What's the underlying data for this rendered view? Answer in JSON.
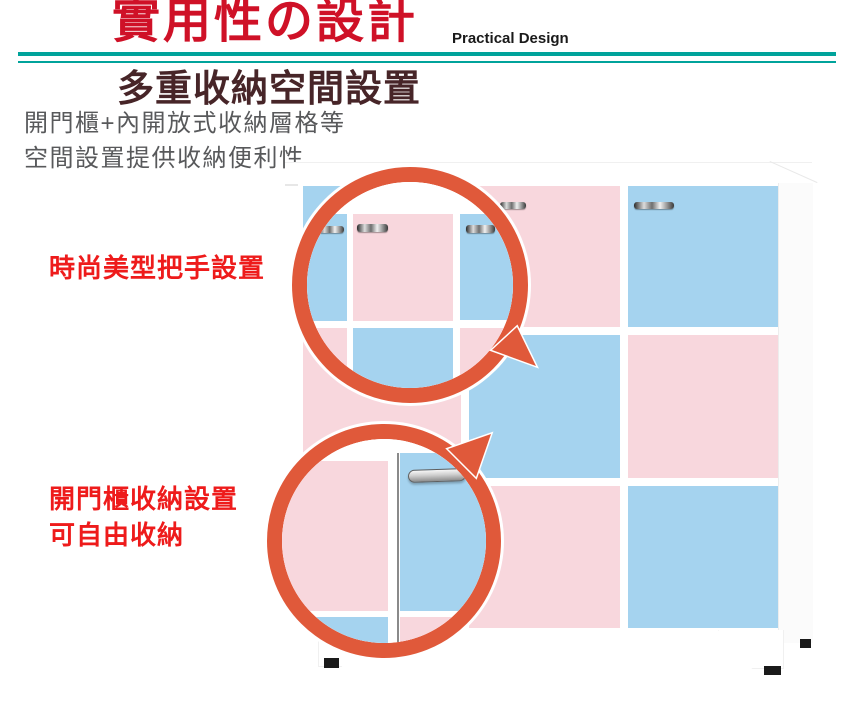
{
  "page": {
    "width": 850,
    "height": 703,
    "background": "#ffffff"
  },
  "header": {
    "title": "實用性の設計",
    "title_color": "#cf1127",
    "subtitle_en": "Practical Design",
    "subtitle_color": "#1a1a1a",
    "divider_color": "#00a39b"
  },
  "section": {
    "title": "多重收納空間設置",
    "title_color": "#472528",
    "description_line1": "開門櫃+內開放式收納層格等",
    "description_line2": "空間設置提供收納便利性",
    "description_color": "#58595b"
  },
  "callouts": {
    "label_color": "#ee1b1b",
    "ring_color": "#e0593a",
    "handle_callout": {
      "label": "時尚美型把手設置"
    },
    "storage_callout": {
      "label_line1": "開門櫃收納設置",
      "label_line2": "可自由收納"
    }
  },
  "cabinet": {
    "pink": "#f8d7dd",
    "blue": "#a5d3ef",
    "frame_color": "#ffffff",
    "foot_color": "#1a1a1a",
    "columns": [
      {
        "x": 303,
        "w": 158,
        "panels": [
          "blue",
          "pink",
          "blue"
        ]
      },
      {
        "x": 469,
        "w": 151,
        "panels": [
          "pink",
          "blue",
          "pink"
        ]
      },
      {
        "x": 628,
        "w": 150,
        "panels": [
          "blue",
          "pink",
          "blue"
        ]
      }
    ],
    "rows": [
      {
        "y": 186,
        "h": 141
      },
      {
        "y": 335,
        "h": 143
      },
      {
        "y": 486,
        "h": 142
      }
    ],
    "handles": [
      {
        "x": 634,
        "y": 202,
        "w": 40,
        "h": 7
      },
      {
        "x": 500,
        "y": 202,
        "w": 26,
        "h": 7
      }
    ]
  }
}
